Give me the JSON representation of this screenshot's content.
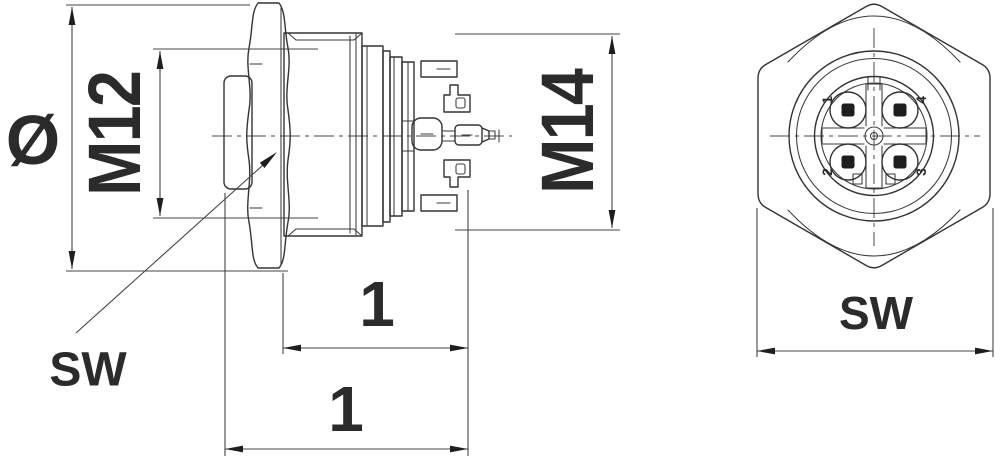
{
  "colors": {
    "background": "#ffffff",
    "line": "#333333",
    "text": "#2b2b2b"
  },
  "side_view": {
    "labels": {
      "diameter": "Ø",
      "coupling_thread": "M12",
      "mounting_thread": "M14",
      "length_front": "1",
      "length_overall": "1",
      "wrench_size": "SW"
    }
  },
  "front_view": {
    "labels": {
      "wrench_size": "SW"
    },
    "pins": {
      "pin1": "1",
      "pin2": "2",
      "pin3": "3",
      "pin4": "4"
    }
  }
}
